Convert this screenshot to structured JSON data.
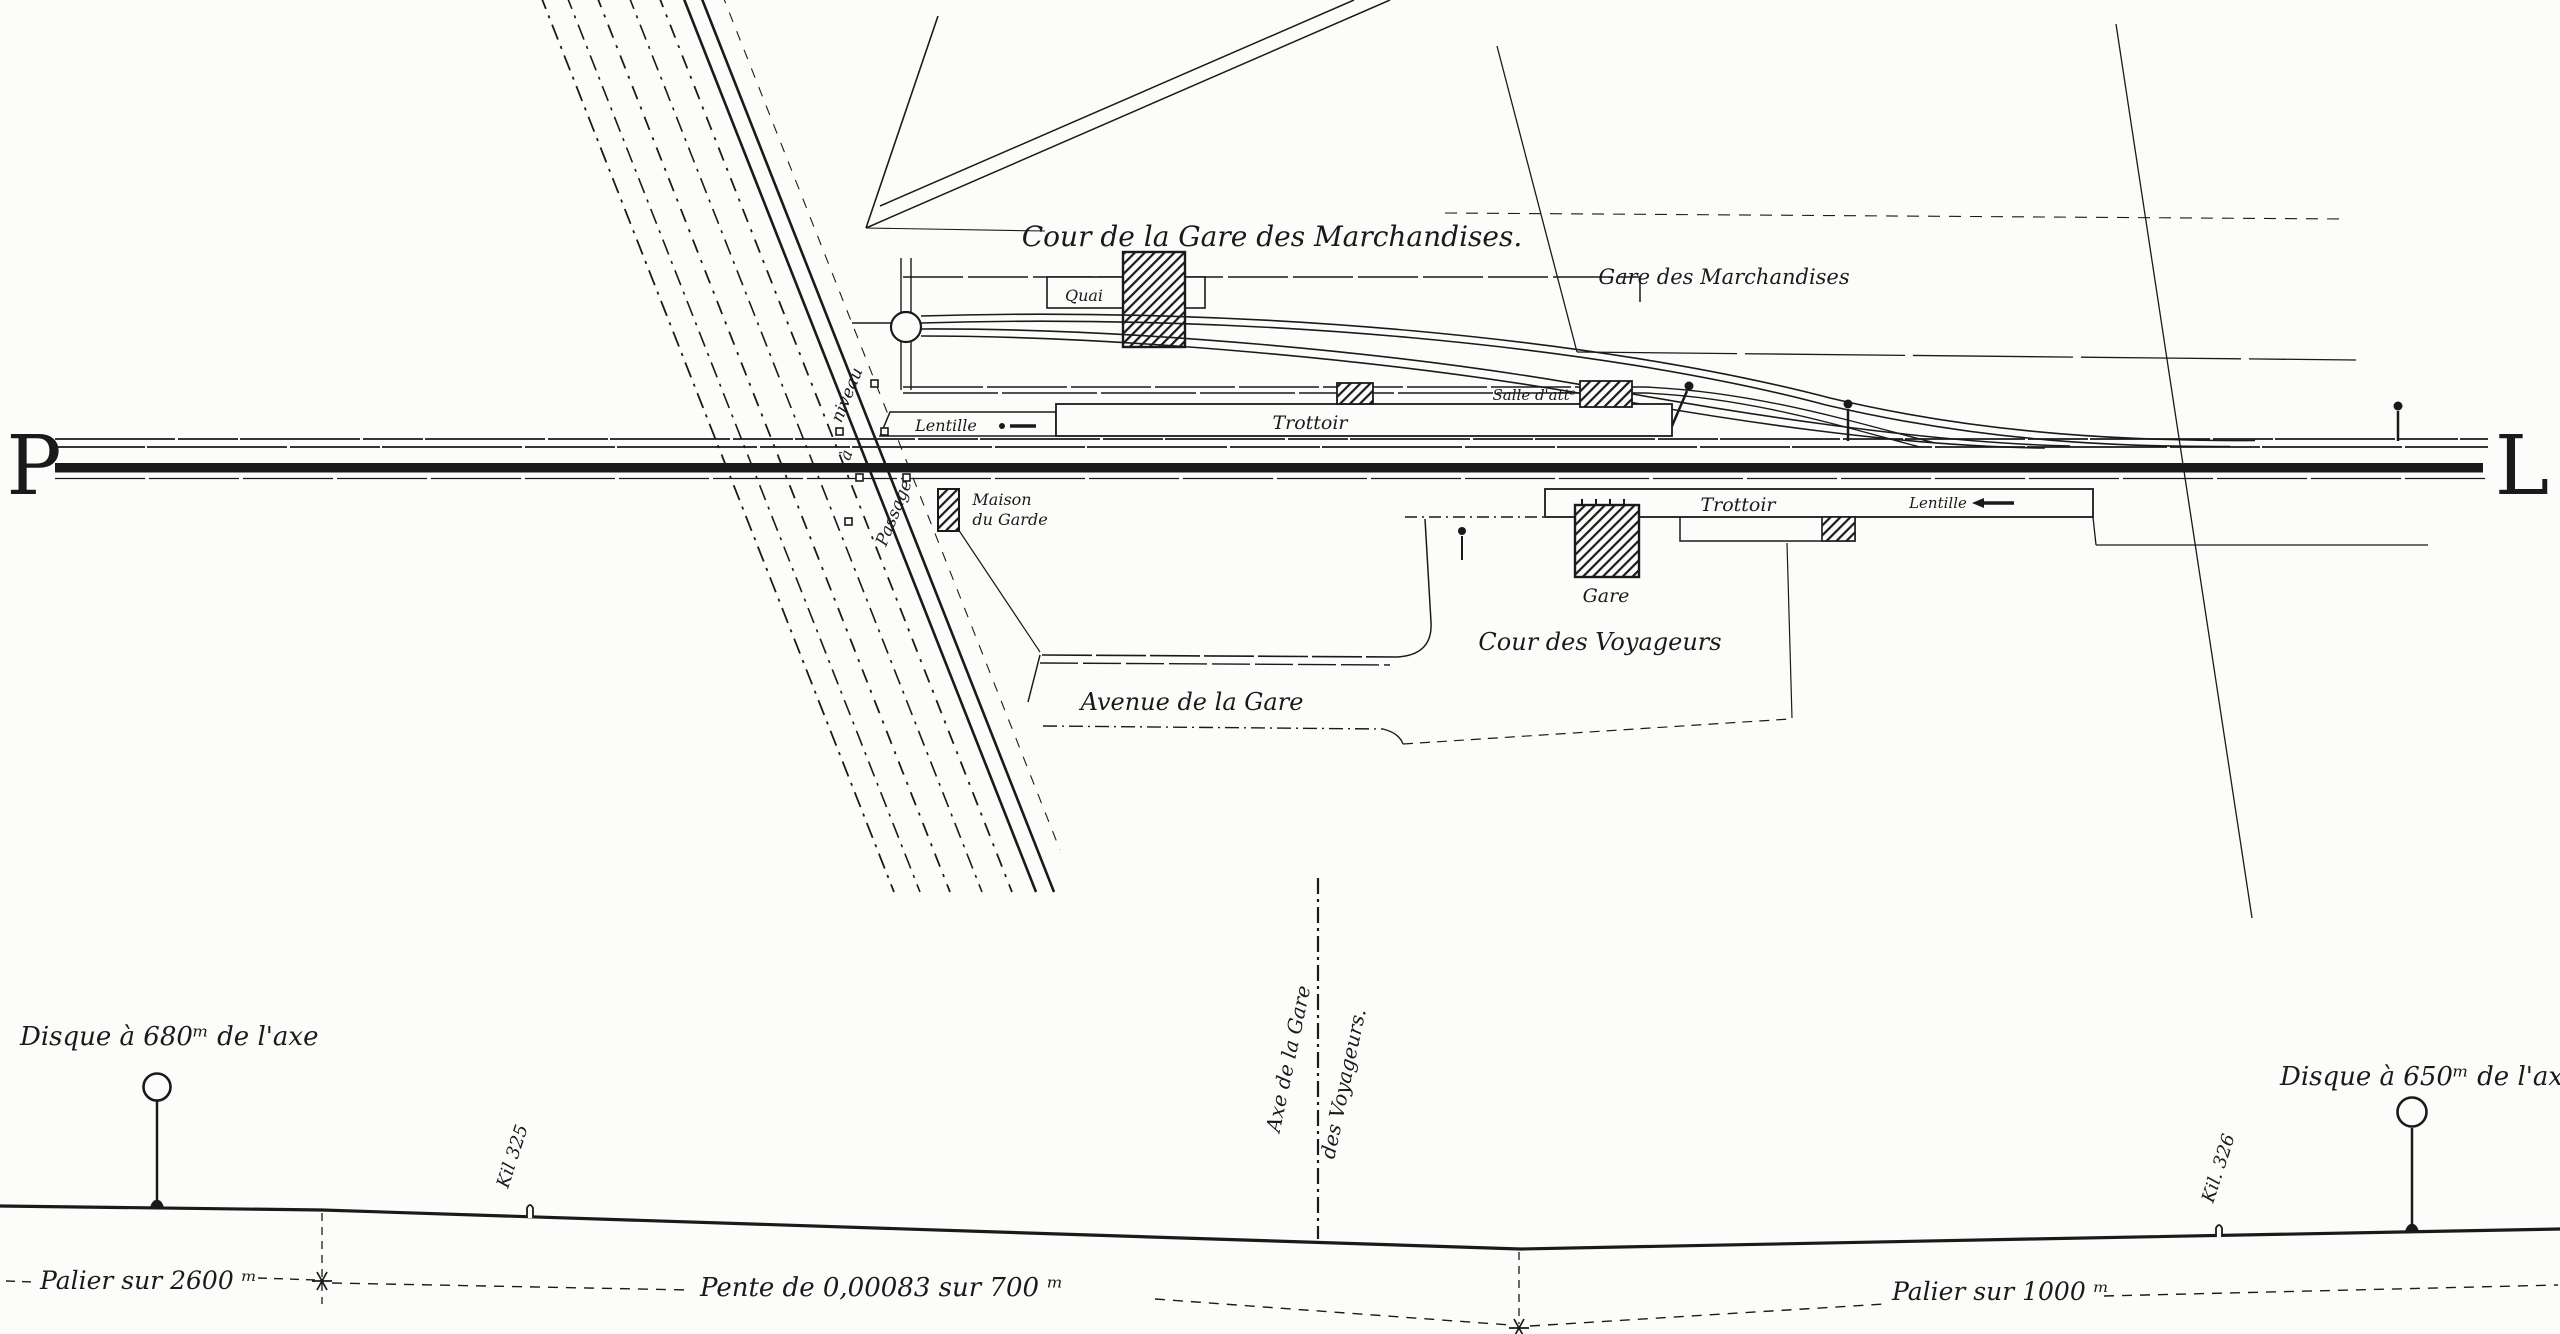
{
  "colors": {
    "ink": "#1a1a1a",
    "paper": "#fcfcfa"
  },
  "plan": {
    "milepost_left": "P",
    "milepost_right": "L",
    "goods_yard": {
      "title": "Cour de la Gare des Marchandises.",
      "station_label": "Gare des Marchandises",
      "platform_label": "Quai"
    },
    "passenger": {
      "upper_platform": "Trottoir",
      "upper_siding_label": "Lentille",
      "waiting_room": "Salle d'attᵉ",
      "station_building": "Gare",
      "lower_platform": "Trottoir",
      "lower_siding_label": "Lentille",
      "courtyard": "Cour des Voyageurs",
      "avenue": "Avenue de la Gare"
    },
    "crossing": {
      "word1": "Passage",
      "word2": "à",
      "word3": "niveau",
      "keeper_house_line1": "Maison",
      "keeper_house_line2": "du Garde"
    }
  },
  "profile": {
    "left_disc": "Disque à 680ᵐ de l'axe",
    "right_disc": "Disque à 650ᵐ de l'axe",
    "km_325": "Kil 325",
    "km_326": "Kil. 326",
    "axis_line1": "Axe de la Gare",
    "axis_line2": "des Voyageurs.",
    "grade_left": "Palier sur 2600 ᵐ",
    "grade_middle": "Pente de 0,00083 sur 700 ᵐ",
    "grade_right": "Palier sur 1000 ᵐ"
  }
}
